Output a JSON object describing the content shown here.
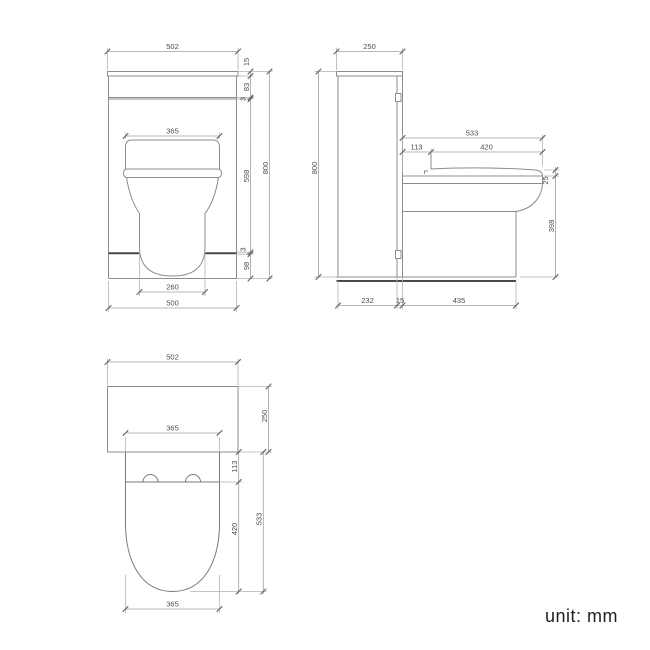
{
  "front_view": {
    "cabinet_width": "502",
    "seat_width": "365",
    "pan_base_width": "260",
    "cabinet_body_width": "500",
    "worktop_thickness": "15",
    "top_panel_height": "83",
    "gap_top": "3",
    "door_height": "598",
    "gap_bottom": "3",
    "plinth_height": "98",
    "overall_height": "800"
  },
  "side_view": {
    "cabinet_depth": "250",
    "overall_height": "800",
    "seat_total_projection": "533",
    "seat_hinge_offset": "113",
    "seat_length": "420",
    "seat_rim_thickness": "25",
    "pan_height": "398",
    "cabinet_body_depth": "232",
    "panel_thickness": "15",
    "pan_projection": "435"
  },
  "plan_view": {
    "cabinet_width": "502",
    "cabinet_depth": "250",
    "seat_width": "365",
    "hinge_offset": "113",
    "seat_length": "420",
    "total_projection": "533",
    "pan_width": "365"
  },
  "footer": {
    "unit_label": "unit: mm"
  },
  "colors": {
    "background": "#ffffff",
    "line": "#8c8c8c",
    "accent_line": "#4a4a4a",
    "dimension_line": "#a0a0a0",
    "text": "#4d4d4d",
    "note_text": "#1f1f1f"
  }
}
